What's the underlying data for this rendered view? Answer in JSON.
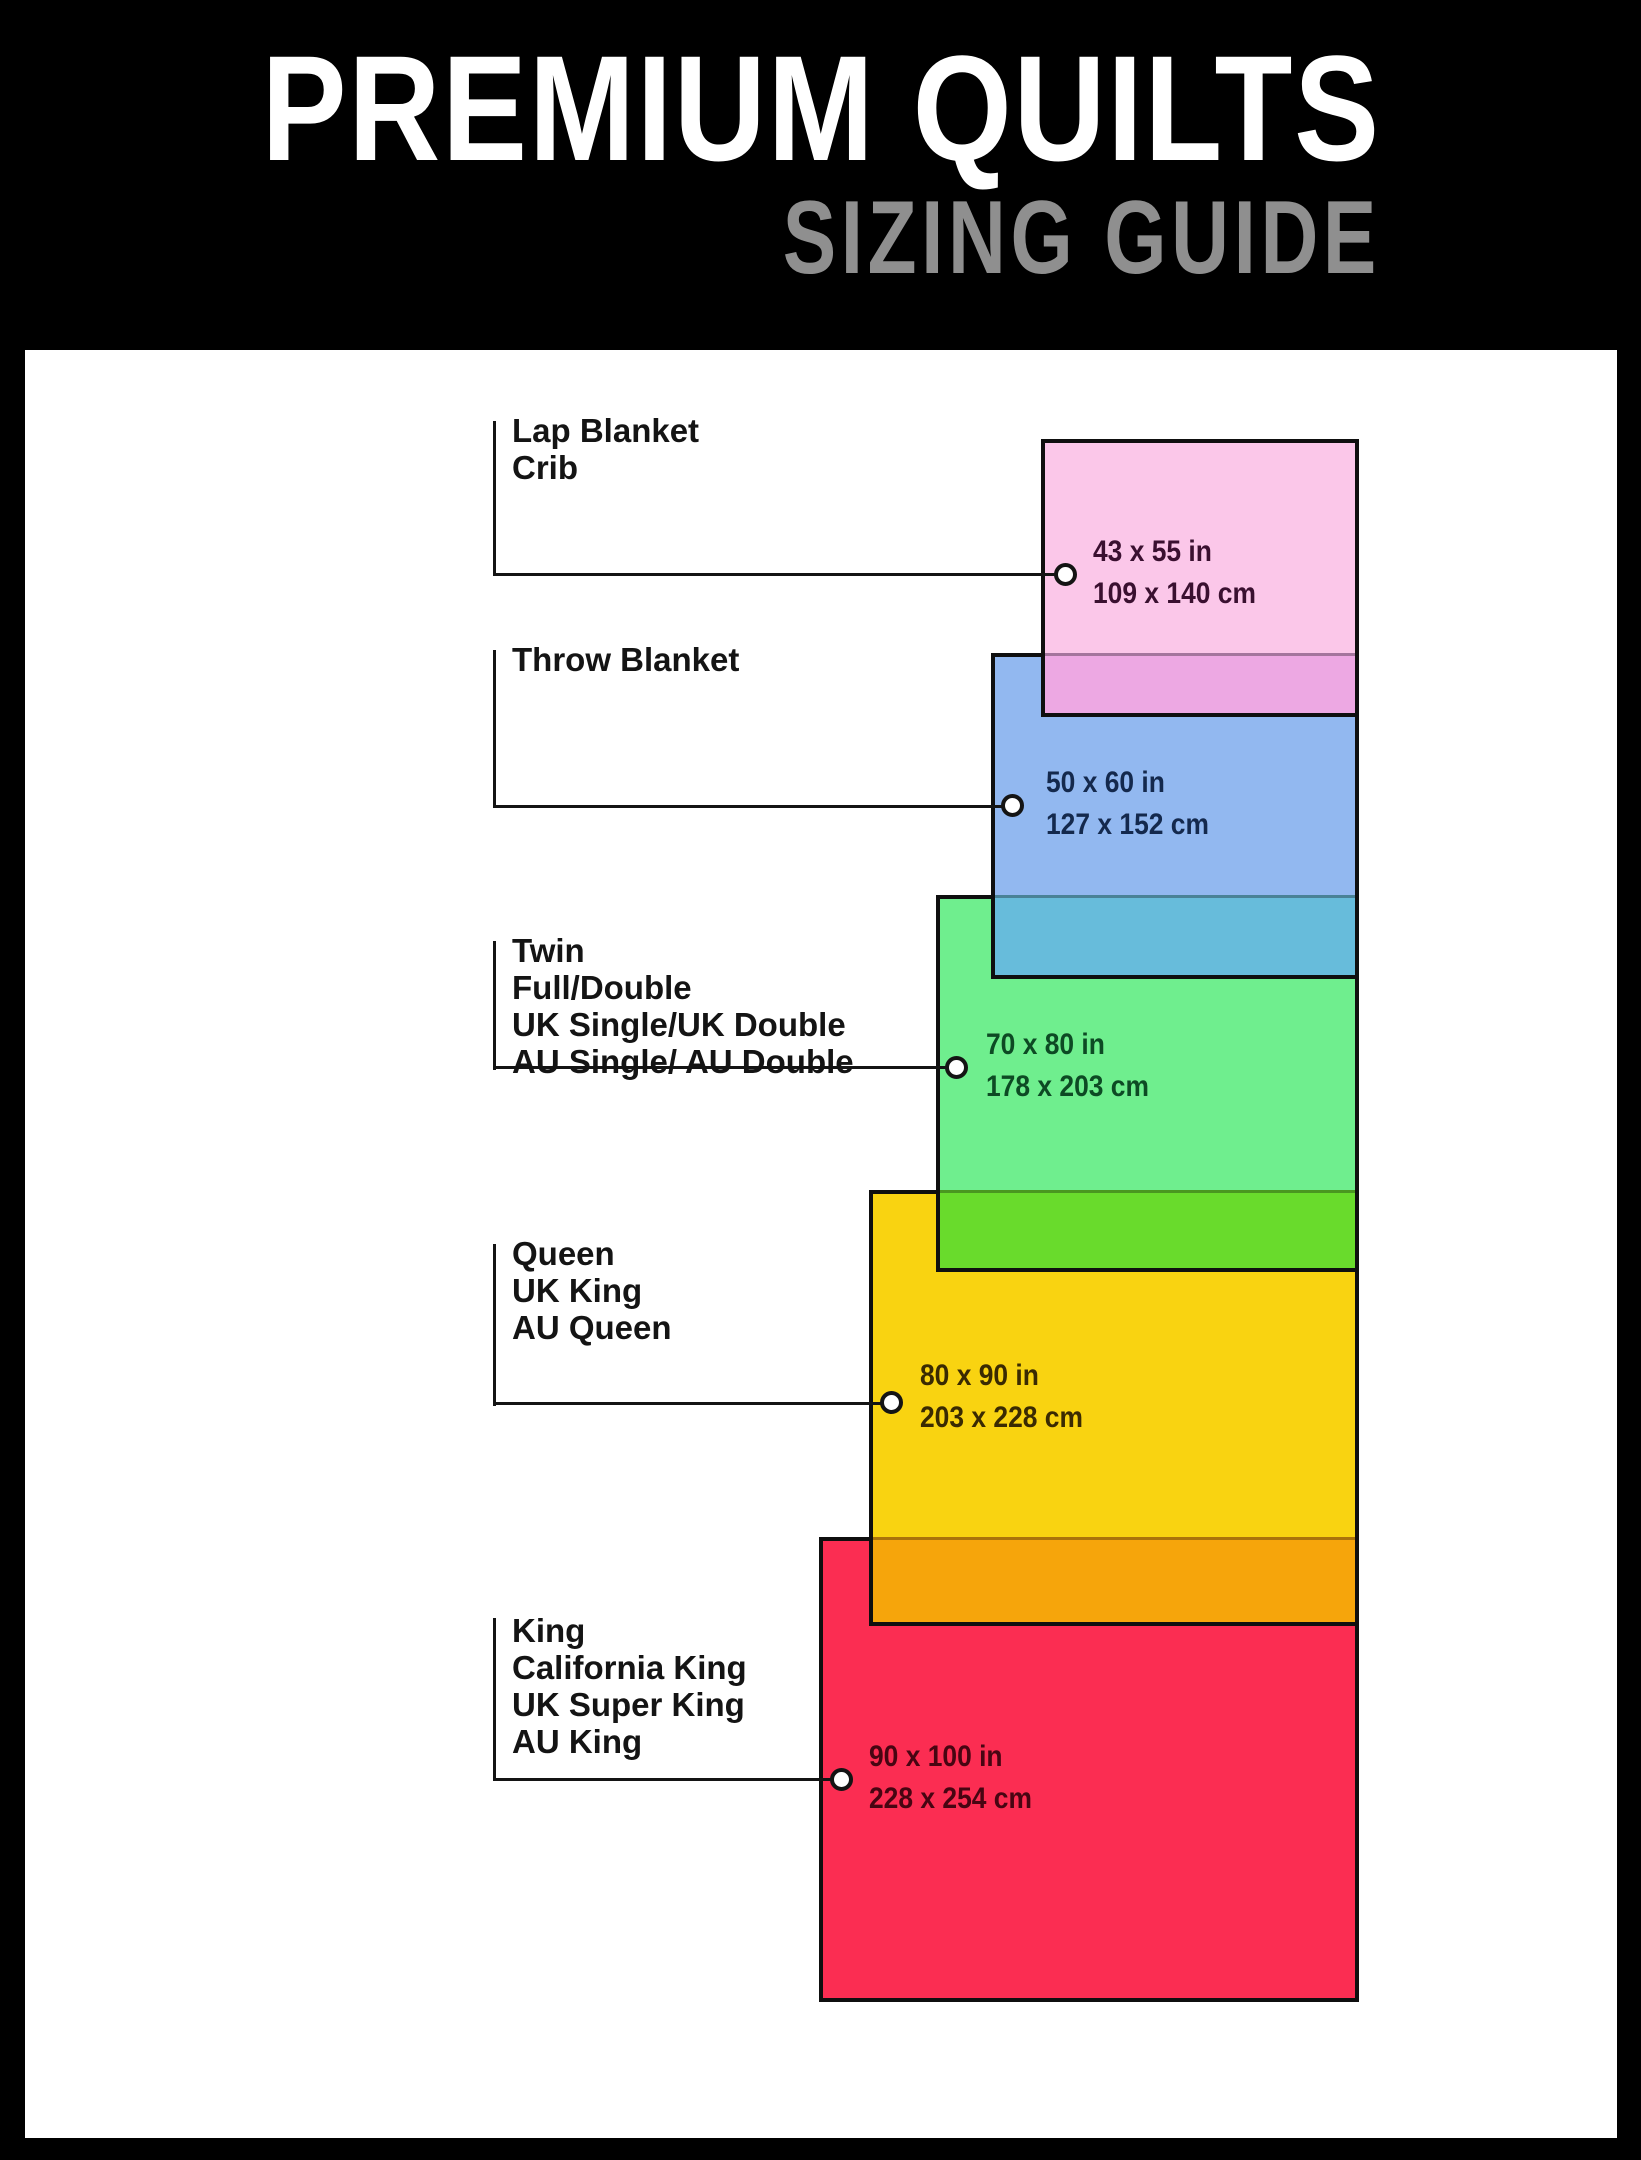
{
  "header": {
    "title": "PREMIUM QUILTS",
    "subtitle": "SIZING GUIDE",
    "title_color": "#ffffff",
    "subtitle_color": "#8f8f8f",
    "background": "#000000"
  },
  "panel": {
    "background": "#ffffff"
  },
  "line_color": "#141414",
  "sizes": [
    {
      "name": "lap-blanket-crib",
      "labels": [
        "Lap Blanket",
        "Crib"
      ],
      "inches": "43 x 55 in",
      "cm": "109 x 140 cm",
      "fill": "#FBC7E9",
      "overlap_fill": "#EDA8E3",
      "text_color": "#3A1030"
    },
    {
      "name": "throw-blanket",
      "labels": [
        "Throw Blanket"
      ],
      "inches": "50 x 60 in",
      "cm": "127 x 152 cm",
      "fill": "#92B8F0",
      "overlap_fill": "#67BCDB",
      "text_color": "#14294D"
    },
    {
      "name": "twin-full-double",
      "labels": [
        "Twin",
        "Full/Double",
        "UK Single/UK Double",
        "AU Single/ AU Double"
      ],
      "inches": "70 x 80 in",
      "cm": "178 x 203 cm",
      "fill": "#6FEE8E",
      "overlap_fill": "#69DB2C",
      "text_color": "#0D4A24"
    },
    {
      "name": "queen",
      "labels": [
        "Queen",
        "UK King",
        "AU Queen"
      ],
      "inches": "80 x 90 in",
      "cm": "203 x 228 cm",
      "fill": "#F9D311",
      "overlap_fill": "#F6A50B",
      "text_color": "#3A2A02"
    },
    {
      "name": "king",
      "labels": [
        "King",
        "California King",
        "UK Super King",
        "AU King"
      ],
      "inches": "90 x 100 in",
      "cm": "228 x 254 cm",
      "fill": "#FB2D52",
      "overlap_fill": "",
      "text_color": "#470512"
    }
  ]
}
